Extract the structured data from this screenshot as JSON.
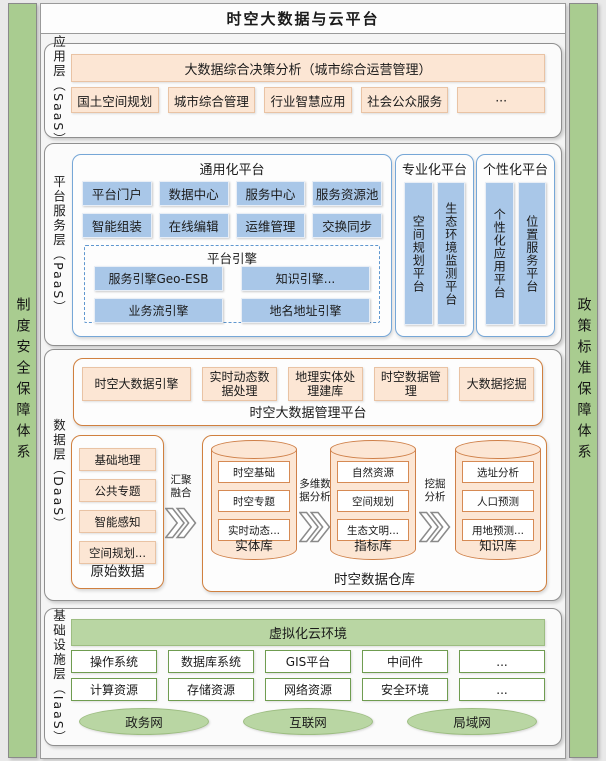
{
  "title": "时空大数据与云平台",
  "side": {
    "left": "制度安全保障体系",
    "right": "政策标准保障体系"
  },
  "saas": {
    "label": "应用层（SaaS）",
    "banner": "大数据综合决策分析（城市综合运营管理）",
    "apps": [
      "国土空间规划",
      "城市综合管理",
      "行业智慧应用",
      "社会公众服务",
      "···"
    ]
  },
  "paas": {
    "label": "平台服务层（PaaS）",
    "general": {
      "title": "通用化平台",
      "cells": [
        "平台门户",
        "数据中心",
        "服务中心",
        "服务资源池",
        "智能组装",
        "在线编辑",
        "运维管理",
        "交换同步"
      ],
      "engine": {
        "title": "平台引擎",
        "cells": [
          "服务引擎Geo-ESB",
          "知识引擎...",
          "业务流引擎",
          "地名地址引擎"
        ]
      }
    },
    "professional": {
      "title": "专业化平台",
      "columns": [
        "空间规划平台",
        "生态环境监测平台"
      ]
    },
    "personalized": {
      "title": "个性化平台",
      "columns": [
        "个性化应用平台",
        "位置服务平台"
      ]
    }
  },
  "daas": {
    "label": "数据层（DaaS）",
    "mgmt": {
      "title": "时空大数据管理平台",
      "cells": [
        "时空大数据引擎",
        "实时动态数据处理",
        "地理实体处理建库",
        "时空数据管理",
        "大数据挖掘"
      ]
    },
    "raw": {
      "title": "原始数据",
      "items": [
        "基础地理",
        "公共专题",
        "智能感知",
        "空间规划..."
      ]
    },
    "flows": [
      "汇聚融合",
      "多维数据分析",
      "挖掘分析"
    ],
    "warehouse": {
      "title": "时空数据仓库",
      "cylinders": [
        {
          "name": "实体库",
          "items": [
            "时空基础",
            "时空专题",
            "实时动态..."
          ]
        },
        {
          "name": "指标库",
          "items": [
            "自然资源",
            "空间规划",
            "生态文明..."
          ]
        },
        {
          "name": "知识库",
          "items": [
            "选址分析",
            "人口预测",
            "用地预测..."
          ]
        }
      ]
    }
  },
  "iaas": {
    "label": "基础设施层（IaaS）",
    "cloud": "虚拟化云环境",
    "software": [
      "操作系统",
      "数据库系统",
      "GIS平台",
      "中间件",
      "..."
    ],
    "resources": [
      "计算资源",
      "存储资源",
      "网络资源",
      "安全环境",
      "..."
    ],
    "networks": [
      "政务网",
      "互联网",
      "局域网"
    ]
  },
  "colors": {
    "green_bar": "#a9cc90",
    "green_light": "#b9d6a3",
    "green_border": "#6f9c50",
    "peach_fill": "#fce6d4",
    "peach_border": "#e9c3a4",
    "orange_border": "#d0803f",
    "blue_fill": "#a9c7e8",
    "blue_border": "#76a7d7",
    "frame_border": "#8f8f8f"
  }
}
